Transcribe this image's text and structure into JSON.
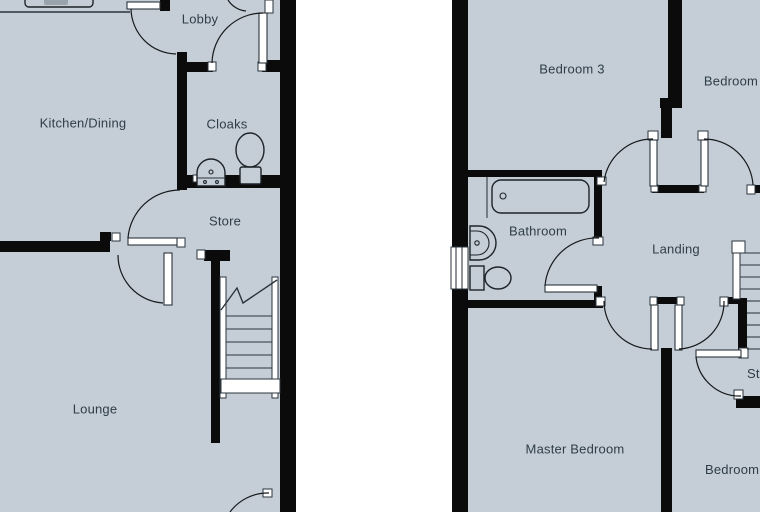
{
  "plans": {
    "ground_floor": {
      "labels": {
        "kitchen_dining": "Kitchen/Dining",
        "lobby": "Lobby",
        "cloaks": "Cloaks",
        "store": "Store",
        "lounge": "Lounge"
      },
      "fixtures": [
        "kitchen-counter-icon",
        "toilet-icon",
        "basin-icon",
        "stairs-icon"
      ]
    },
    "first_floor": {
      "labels": {
        "bedroom3": "Bedroom 3",
        "bedroom_top_right": "Bedroom",
        "bathroom": "Bathroom",
        "landing": "Landing",
        "master_bedroom": "Master Bedroom",
        "bedroom_bottom_right": "Bedroom",
        "store": "Store"
      },
      "fixtures": [
        "bath-icon",
        "basin-icon",
        "toilet-icon",
        "window-icon",
        "stairs-icon"
      ]
    }
  },
  "colors": {
    "floor": "#c5ced6",
    "wall": "#0b0b0c",
    "stroke": "#2b343c",
    "text": "#2e3d49"
  }
}
